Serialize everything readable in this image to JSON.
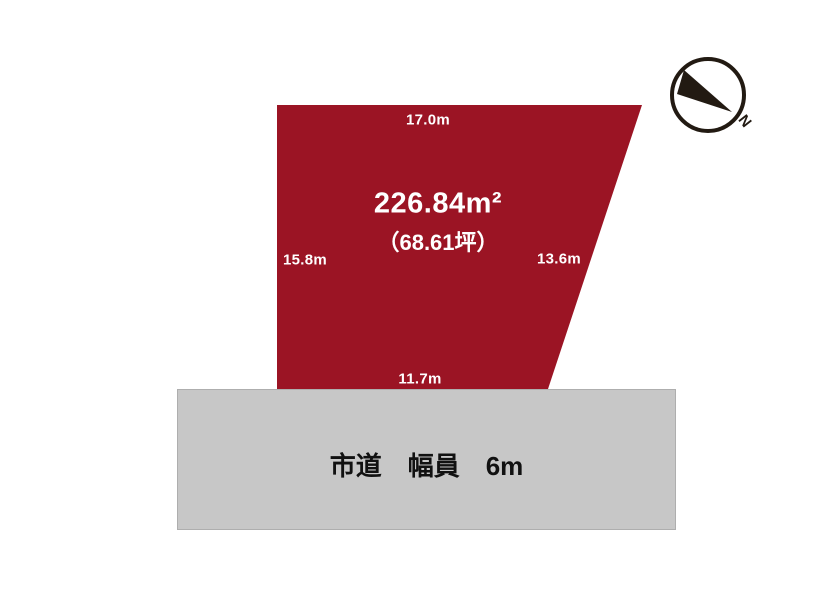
{
  "plot": {
    "area_m2": "226.84m²",
    "area_tsubo": "（68.61坪）",
    "dim_top": "17.0m",
    "dim_left": "15.8m",
    "dim_right": "13.6m",
    "dim_bottom": "11.7m"
  },
  "road": {
    "label": "市道　幅員　6m"
  },
  "compass": {
    "letter": "N"
  },
  "colors": {
    "parcel_fill": "#9b1424",
    "parcel_text": "#ffffff",
    "road_fill": "#c7c7c7",
    "road_border": "#aeaeae",
    "road_text": "#111111",
    "compass_ink": "#221a12",
    "background": "#ffffff"
  }
}
